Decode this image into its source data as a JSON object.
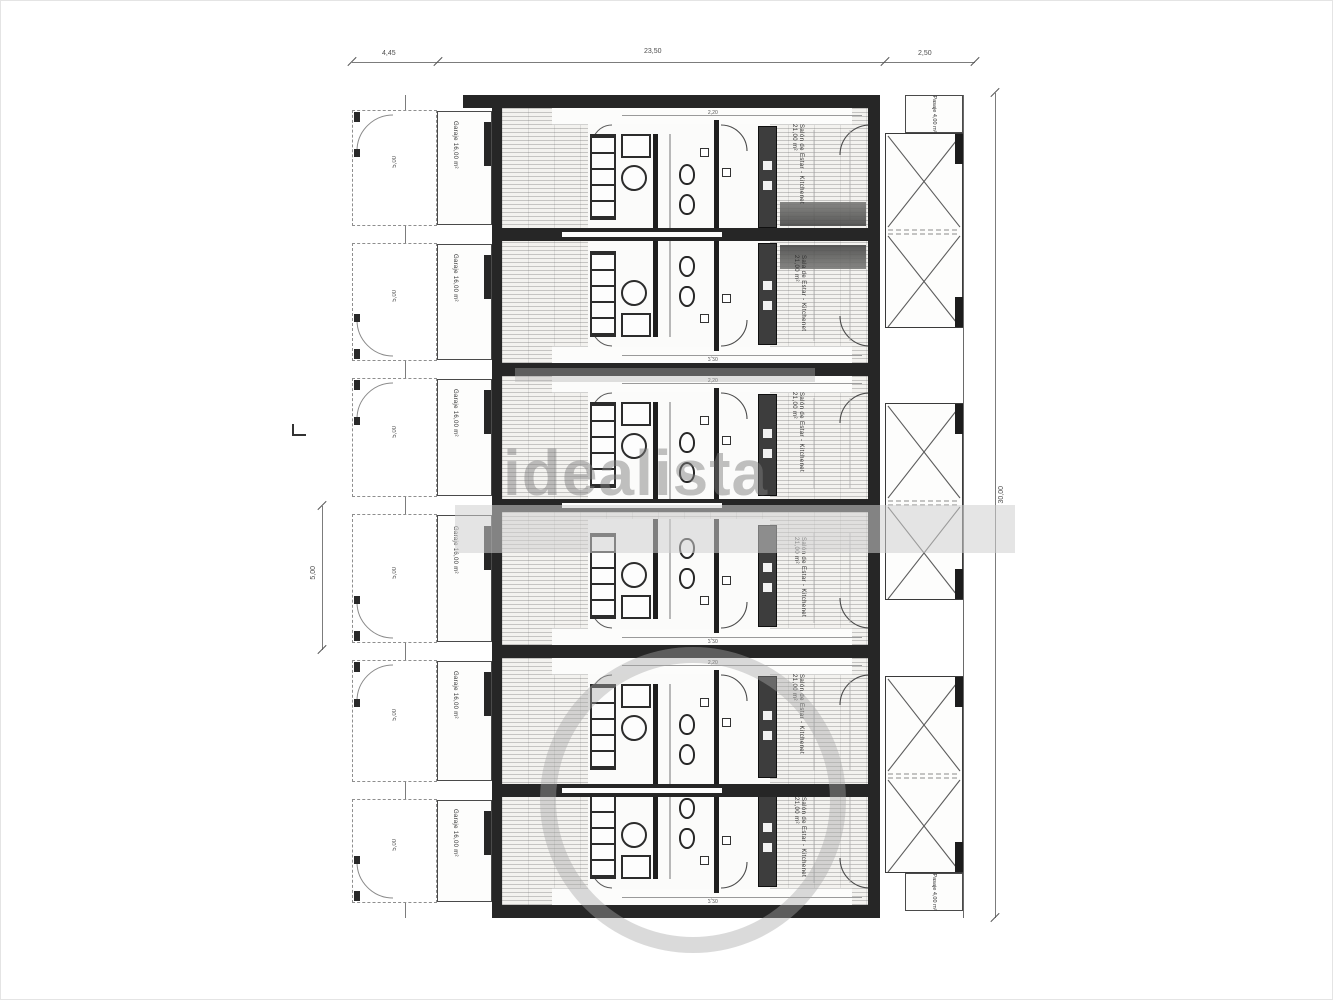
{
  "watermark": {
    "text": "idealista",
    "color": "#7d7d7d"
  },
  "dims": {
    "top": [
      "4,45",
      "23,50",
      "2,50"
    ],
    "right_total": "30,00",
    "left_mid": "5,00"
  },
  "passages": {
    "top": "Pasaje 4,00 m²",
    "bottom": "Pasaje 4,00 m²"
  },
  "units": [
    {
      "garage_label": "Garaje 16,00 m²",
      "living_label": "Salón de Estar - Kitchenet 21,00 m²",
      "inner_dim": "2,20",
      "row_dim": "5,00",
      "counter": true
    },
    {
      "garage_label": "Garaje 16,00 m²",
      "living_label": "Sala de Estar - Kitchenet 21,00 m²",
      "inner_dim": "2,20",
      "row_dim": "5,00",
      "counter": true
    },
    {
      "garage_label": "Garaje 16,00 m²",
      "living_label": "Salón de Estar - Kitchenet 21,00 m²",
      "inner_dim": "2,20",
      "row_dim": "5,00",
      "counter": false
    },
    {
      "garage_label": "Garaje 16,00 m²",
      "living_label": "Salón de Estar - Kitchenet 21,00 m²",
      "inner_dim": "2,20",
      "row_dim": "5,00",
      "counter": false
    },
    {
      "garage_label": "Garaje 16,00 m²",
      "living_label": "Salón de Estar - Kitchenet 21,00 m²",
      "inner_dim": "2,20",
      "row_dim": "5,00",
      "counter": false
    },
    {
      "garage_label": "Garaje 16,00 m²",
      "living_label": "Salón de Estar - Kitchenet 21,00 m²",
      "inner_dim": "2,20",
      "row_dim": "5,00",
      "counter": false
    }
  ]
}
